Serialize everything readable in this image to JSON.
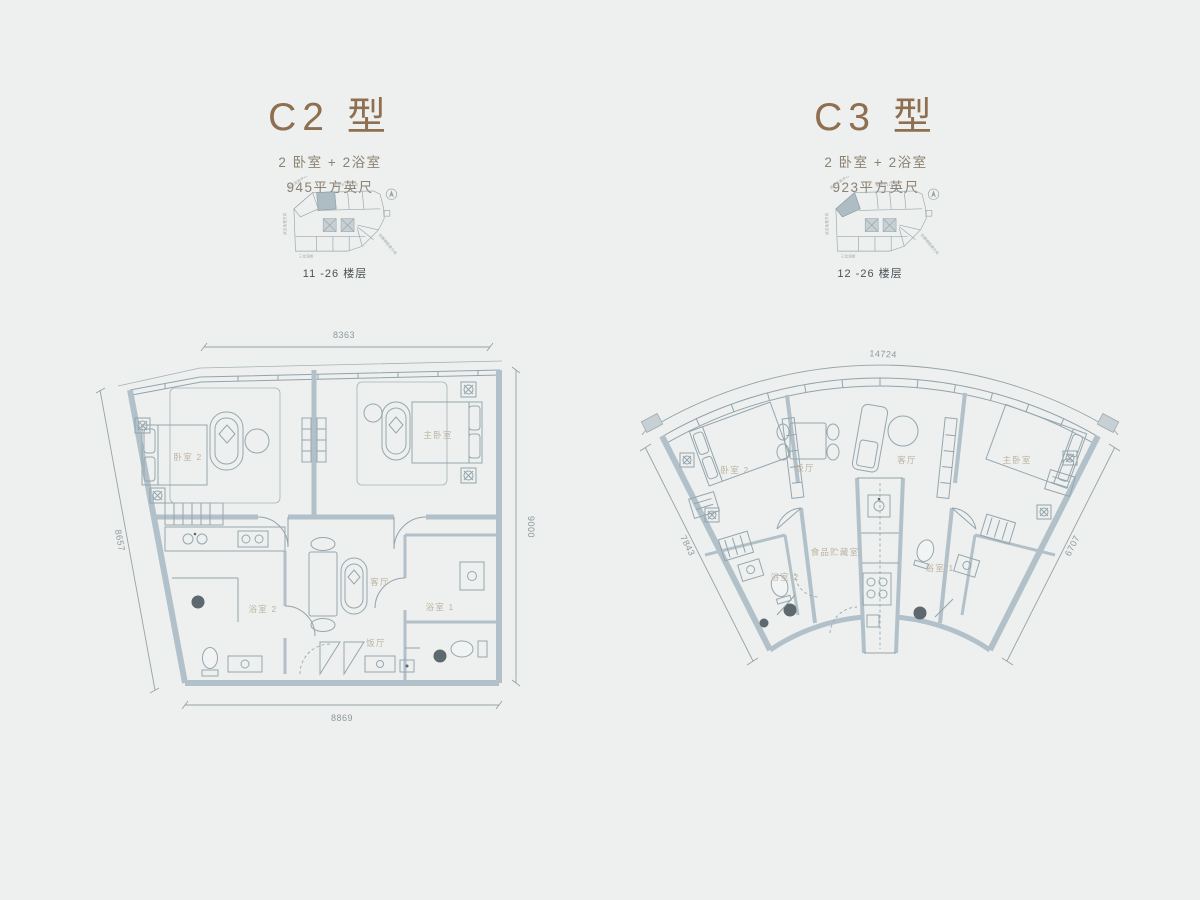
{
  "c2": {
    "title": "C2 型",
    "config": "2 卧室 + 2浴室",
    "area": "945平方英尺",
    "floors": "11 -26 楼层",
    "dims": {
      "top": "8363",
      "right": "9000",
      "bottom": "8869",
      "left": "8657"
    },
    "rooms": {
      "bedroom2": "卧室 2",
      "master": "主卧室",
      "living": "客厅",
      "dining": "饭厅",
      "bath1": "浴室 1",
      "bath2": "浴室 2"
    }
  },
  "c3": {
    "title": "C3 型",
    "config": "2 卧室 + 2浴室",
    "area": "923平方英尺",
    "floors": "12 -26 楼层",
    "dims": {
      "top": "14724",
      "left": "7843",
      "right": "6707"
    },
    "rooms": {
      "bedroom2": "卧室 2",
      "dining": "饭厅",
      "living": "客厅",
      "master": "主卧室",
      "bath2": "浴室 2",
      "pantry": "食品贮藏室",
      "bath1": "浴室 1"
    }
  },
  "keyplan": {
    "top": "默迪卡118方向",
    "topleft": "国际贸易中心方向",
    "left": "武吉免登方向",
    "right": "往精明隧道方向",
    "bottom": "三岔湾街"
  },
  "colors": {
    "title": "#8e6f50",
    "wall": "#b2c1c9",
    "line": "#93a3ac",
    "room_label": "#bdb3a2",
    "dimension": "#8d989e",
    "background": "#edf0ee"
  }
}
